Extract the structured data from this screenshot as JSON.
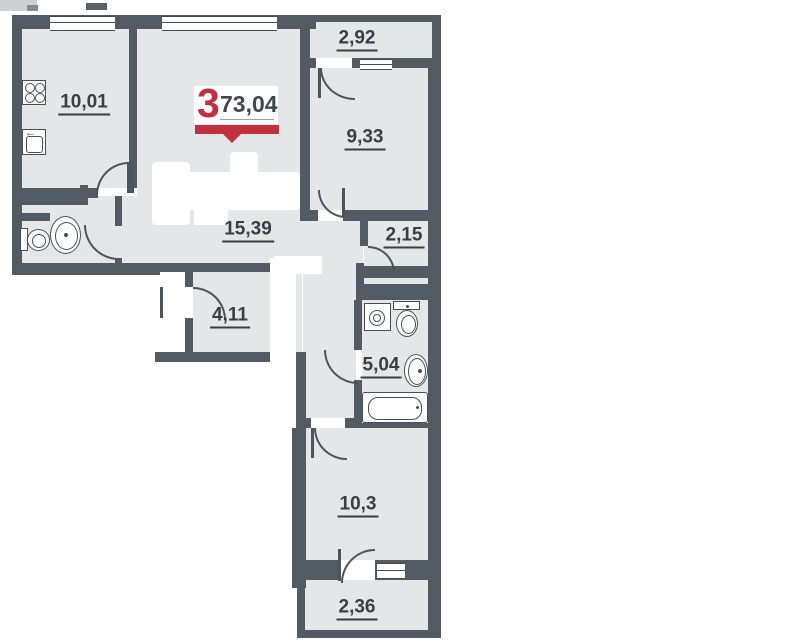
{
  "badge": {
    "rooms_count": "3",
    "total_area": "73,04"
  },
  "rooms": {
    "kitchen": {
      "area": "10,01"
    },
    "balcony_top": {
      "area": "2,92"
    },
    "bedroom_right": {
      "area": "9,33"
    },
    "hallway": {
      "area": "15,39"
    },
    "corridor": {
      "area": "2,15"
    },
    "wardrobe": {
      "area": "4,11"
    },
    "bathroom": {
      "area": "5,04"
    },
    "bedroom_bottom": {
      "area": "10,3"
    },
    "balcony_bottom": {
      "area": "2,36"
    }
  },
  "colors": {
    "wall": "#525a63",
    "floor": "#e5e6e7",
    "accent_red": "#c1303f",
    "label_text": "#383e44"
  },
  "fixtures": {
    "kitchen": [
      "stove-icon",
      "kitchen-sink-icon"
    ],
    "wc": [
      "toilet-icon",
      "washbasin-icon"
    ],
    "bathroom": [
      "washing-machine-icon",
      "toilet-icon",
      "washbasin-icon",
      "bathtub-icon"
    ]
  }
}
